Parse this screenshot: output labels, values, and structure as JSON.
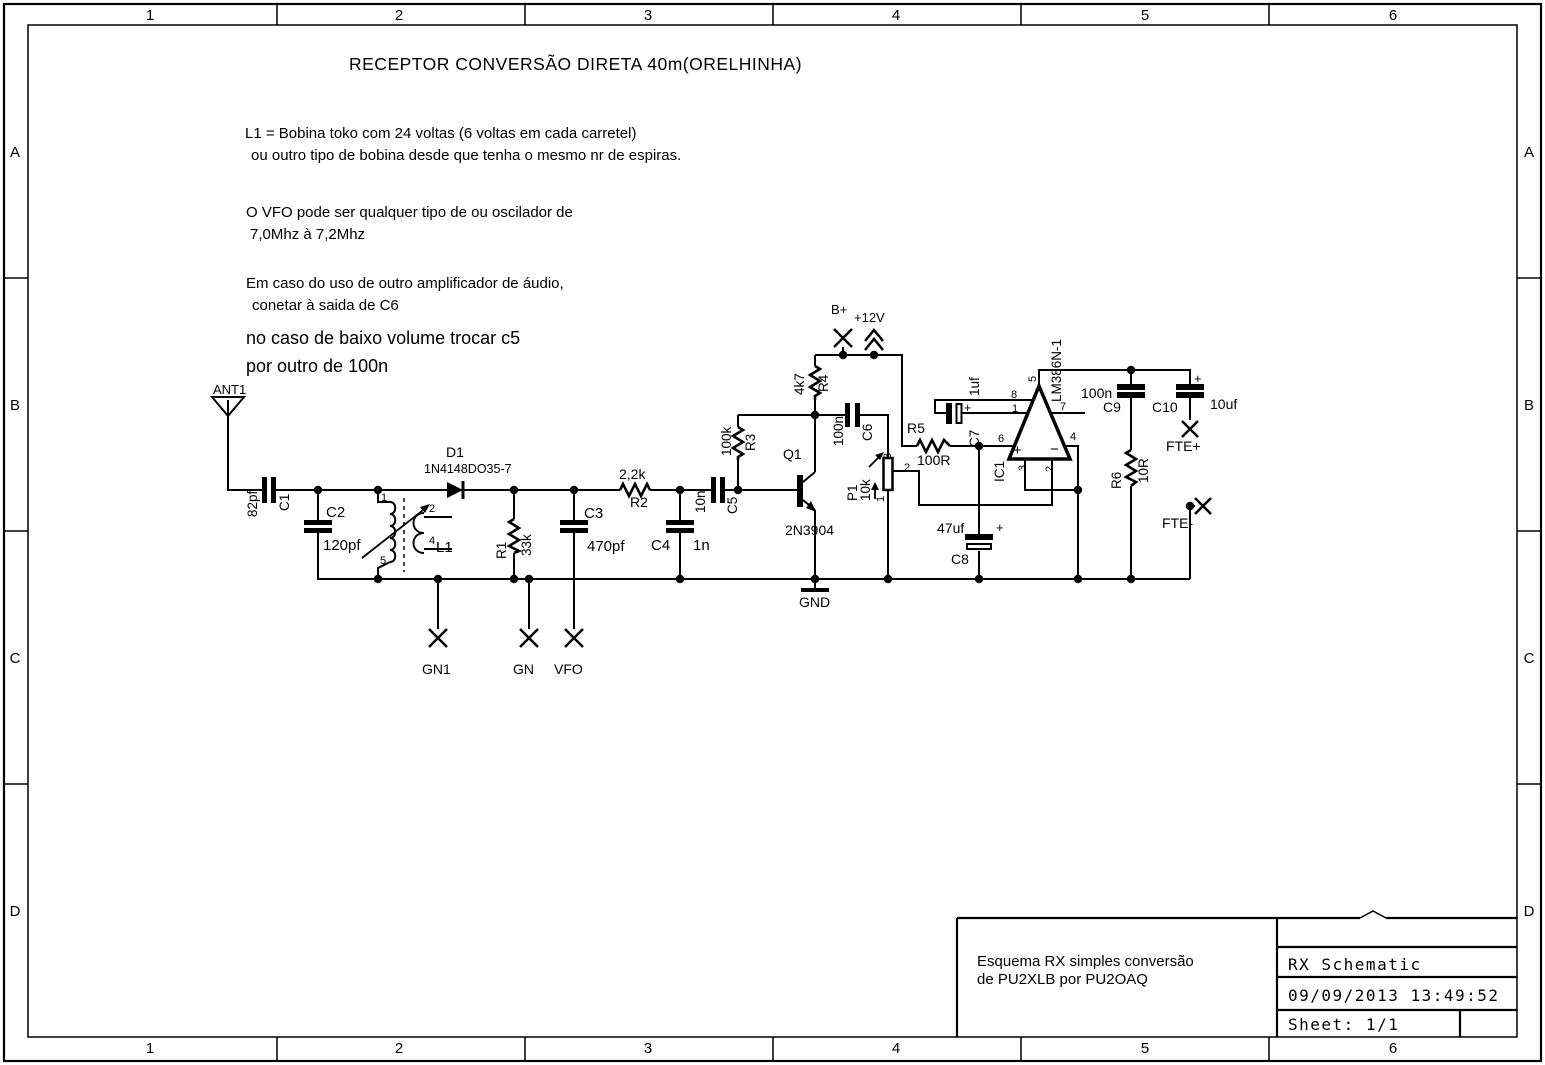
{
  "border": {
    "cols": [
      "1",
      "2",
      "3",
      "4",
      "5",
      "6"
    ],
    "rows": [
      "A",
      "B",
      "C",
      "D"
    ]
  },
  "title": "RECEPTOR CONVERSÃO DIRETA 40m(ORELHINHA)",
  "notes": {
    "l1a": "L1 = Bobina toko com 24 voltas (6 voltas em cada carretel)",
    "l1b": "ou outro tipo de bobina desde que tenha o mesmo nr de espiras.",
    "vfoa": "O VFO pode ser qualquer tipo de ou oscilador de",
    "vfob": "7,0Mhz à 7,2Mhz",
    "ampa": "Em caso do uso de outro amplificador de áudio,",
    "ampb": "conetar à saida de C6",
    "vola": "no caso de baixo volume trocar c5",
    "volb": "por outro de 100n"
  },
  "components": {
    "ant1": {
      "ref": "ANT1"
    },
    "c1": {
      "ref": "C1",
      "value": "82pf"
    },
    "c2": {
      "ref": "C2",
      "value": "120pf"
    },
    "c3": {
      "ref": "C3",
      "value": "470pf"
    },
    "c4": {
      "ref": "C4",
      "value": "1n"
    },
    "c5": {
      "ref": "C5",
      "value": "10n"
    },
    "c6": {
      "ref": "C6",
      "value": "100n"
    },
    "c7": {
      "ref": "C7",
      "value": "1uf",
      "polarity": "+"
    },
    "c8": {
      "ref": "C8",
      "value": "47uf",
      "polarity": "+"
    },
    "c9": {
      "ref": "C9",
      "value": "100n"
    },
    "c10": {
      "ref": "C10",
      "value": "10uf",
      "polarity": "+"
    },
    "r1": {
      "ref": "R1",
      "value": "33k"
    },
    "r2": {
      "ref": "R2",
      "value": "2,2k"
    },
    "r3": {
      "ref": "R3",
      "value": "100k"
    },
    "r4": {
      "ref": "R4",
      "value": "4k7"
    },
    "r5": {
      "ref": "R5",
      "value": "100R"
    },
    "r6": {
      "ref": "R6",
      "value": "10R"
    },
    "d1": {
      "ref": "D1",
      "value": "1N4148DO35-7"
    },
    "q1": {
      "ref": "Q1",
      "value": "2N3904"
    },
    "l1": {
      "ref": "L1",
      "pin1": "1",
      "pin2": "2",
      "pin4": "4",
      "pin5": "5"
    },
    "p1": {
      "ref": "P1",
      "value": "10k",
      "pin1": "1",
      "pin2": "2",
      "pin3": "3"
    },
    "ic1": {
      "ref": "IC1",
      "value": "LM386N-1",
      "plus": "+",
      "minus": "−",
      "pin1": "1",
      "pin2": "2",
      "pin3": "3",
      "pin4": "4",
      "pin5": "5",
      "pin6": "6",
      "pin7": "7",
      "pin8": "8"
    }
  },
  "terminals": {
    "bplus": "B+",
    "v12": "+12V",
    "gn1": "GN1",
    "gn": "GN",
    "vfo": "VFO",
    "gnd": "GND",
    "ftep": "FTE+",
    "ftem": "FTE-"
  },
  "title_block": {
    "desc1": "Esquema RX simples  conversão",
    "desc2": "de PU2XLB por PU2OAQ",
    "doc": "RX Schematic",
    "datetime": "09/09/2013 13:49:52",
    "sheet": "Sheet: 1/1"
  }
}
